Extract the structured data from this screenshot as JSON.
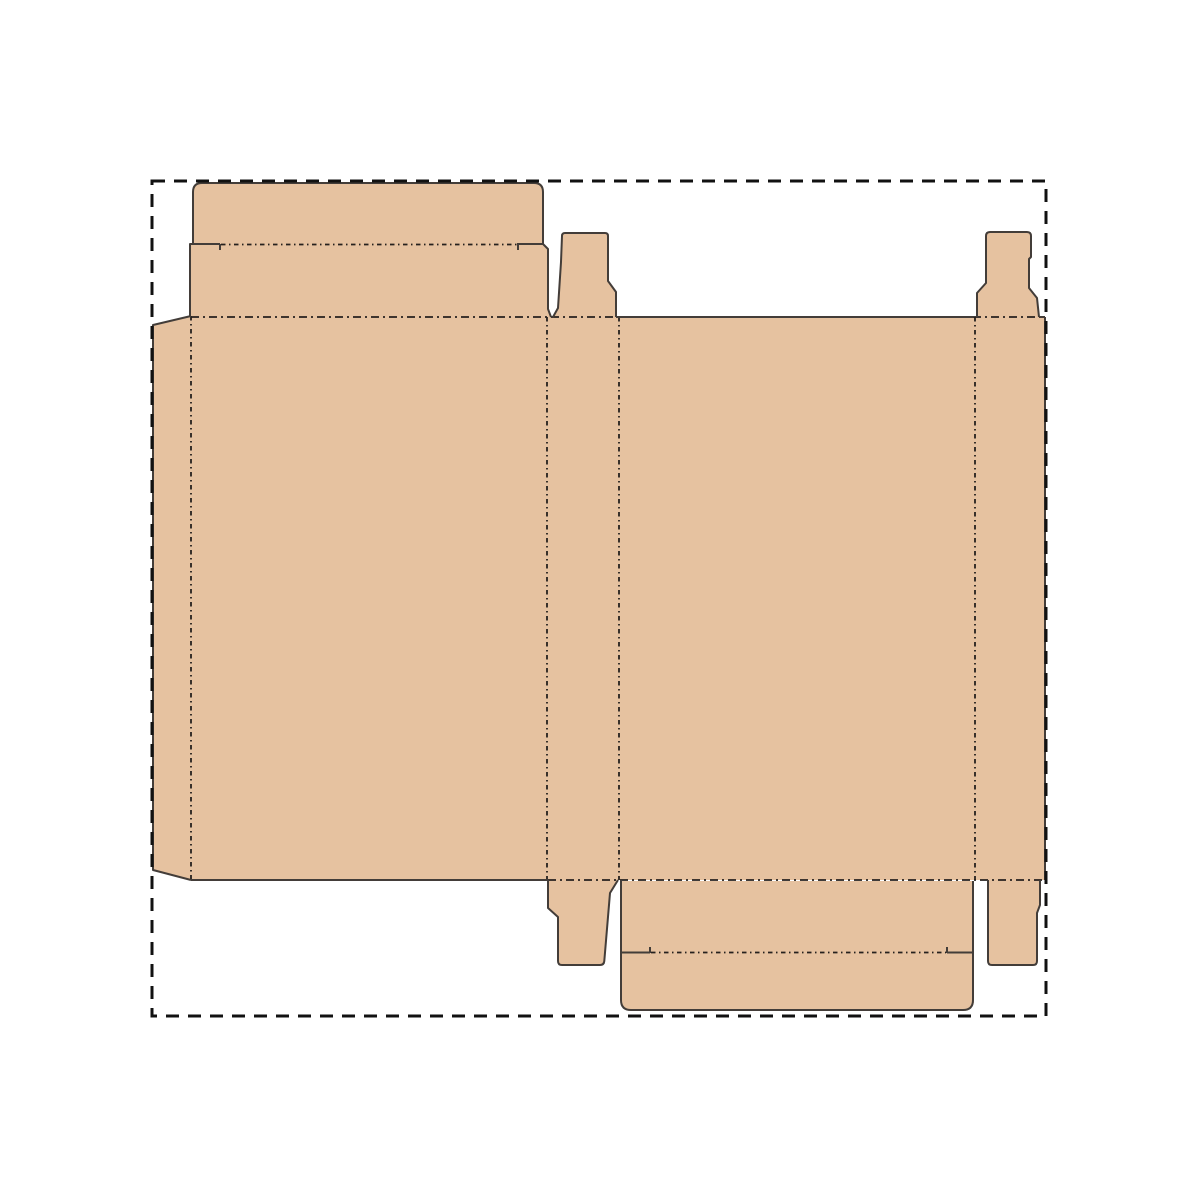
{
  "diagram": {
    "kind": "packaging-dieline",
    "description": "Unfolded carton box die-cut template with cut and crease lines inside a dashed artboard boundary"
  },
  "colors": {
    "background": "#ffffff",
    "board_fill": "#e6c2a0",
    "cut_line": "#433d39",
    "fold_line": "#26211e",
    "boundary_line": "#111111"
  },
  "parts": {
    "glue_flap": "glue flap",
    "front_panel": "front panel",
    "side_panel_left": "side panel",
    "back_panel": "back panel",
    "side_panel_right": "side panel",
    "top_tuck_flap": "top tuck flap",
    "top_dust_flap": "top dust flap",
    "bottom_tuck_flap": "bottom tuck flap",
    "bottom_dust_flap": "bottom dust flap"
  }
}
